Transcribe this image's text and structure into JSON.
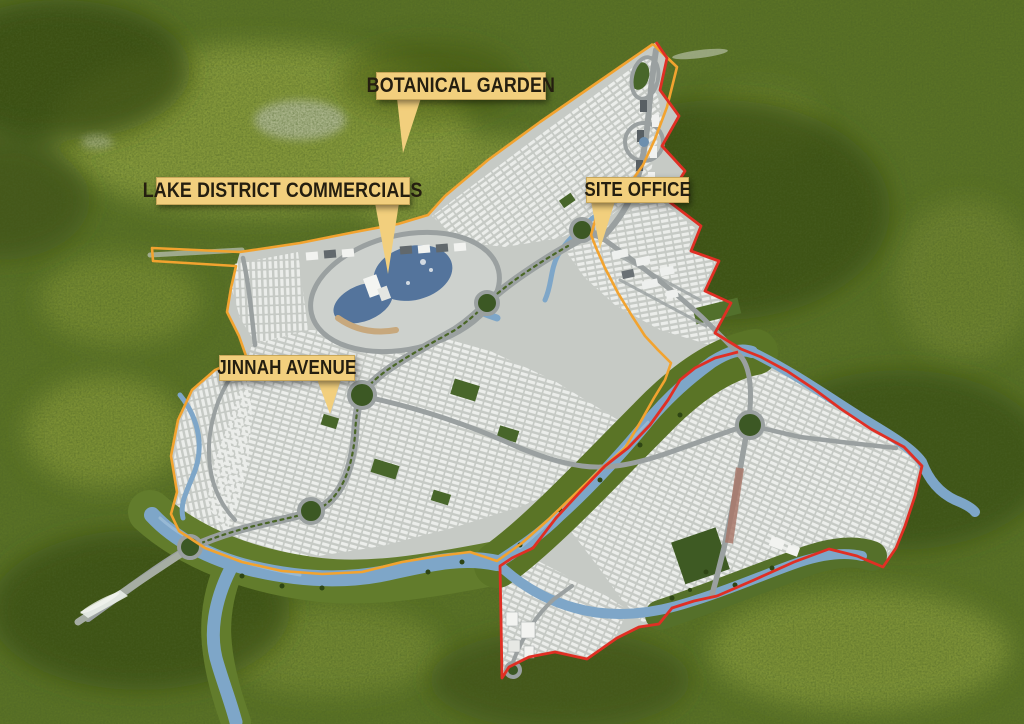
{
  "map": {
    "description": "Aerial 3D masterplan map of a housing development surrounded by forest",
    "callouts": [
      {
        "id": "botanical-garden",
        "text": "BOTANICAL GARDEN"
      },
      {
        "id": "lake-district-commercials",
        "text": "LAKE DISTRICT COMMERCIALS"
      },
      {
        "id": "site-office",
        "text": "SITE OFFICE"
      },
      {
        "id": "jinnah-avenue",
        "text": "JINNAH AVENUE"
      }
    ],
    "features": [
      "forest",
      "lake",
      "rivers",
      "residential-sectors",
      "roundabouts",
      "jinnah-avenue-road",
      "red-phase-boundary",
      "orange-phase-boundary",
      "cricket-ground-park",
      "site-office-district",
      "lake-district-commercials"
    ],
    "colors": {
      "forest_base": "#5a7226",
      "forest_dark": "#35490f",
      "forest_light": "#8a9c3d",
      "development": "#c6cac5",
      "road": "#9aa0a0",
      "lake_water": "#54749c",
      "river_water": "#7ea6c8",
      "boundary_red": "#e02f24",
      "boundary_orange": "#f2a32f",
      "label_background": "#f2cf7d",
      "label_text": "#241e10",
      "park_green": "#48662a"
    }
  }
}
